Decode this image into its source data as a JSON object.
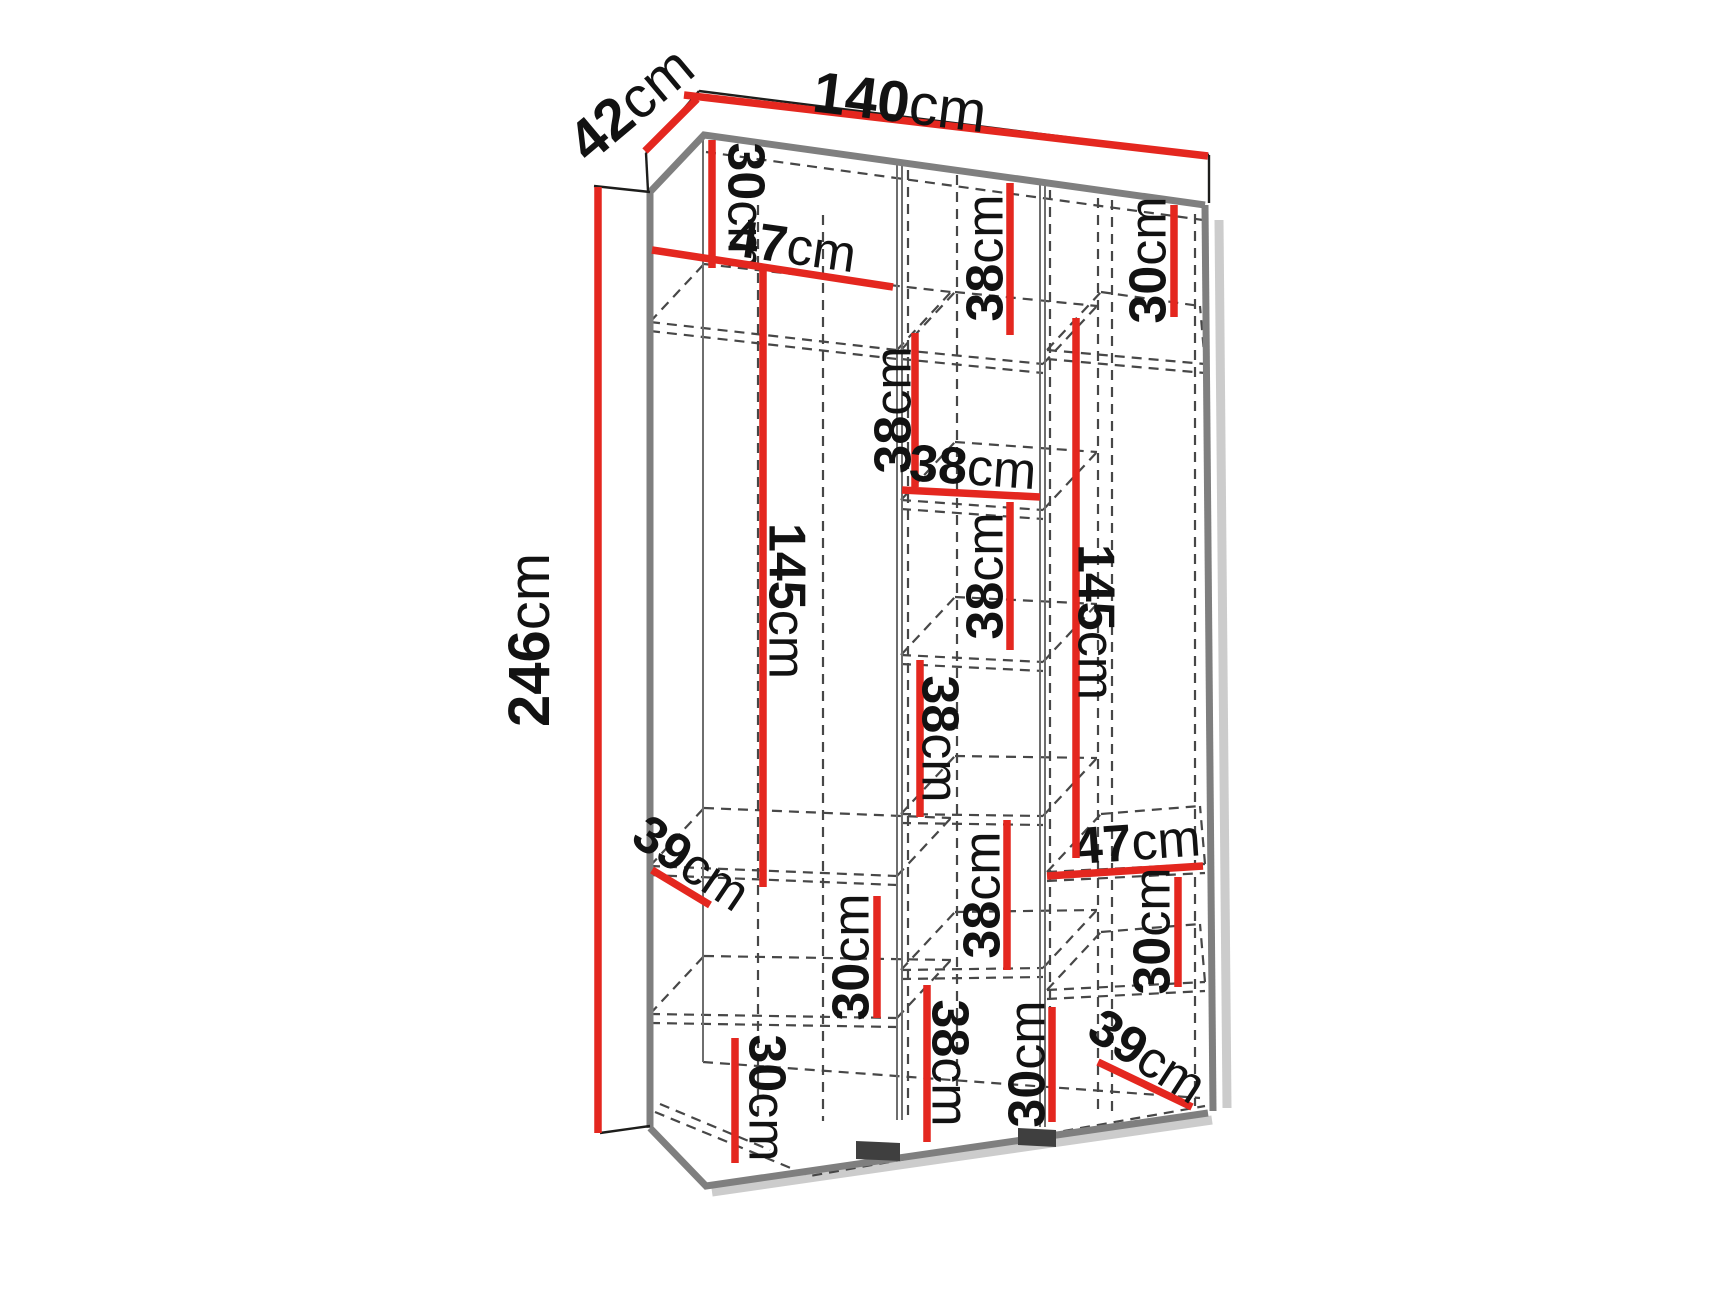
{
  "units": "cm",
  "colors": {
    "dimension_red": "#e4271f",
    "outline_black": "#1d1d1b",
    "panel_gray": "#7f7f7f",
    "partition_gray": "#6e6e6e",
    "dash_gray": "#474747",
    "feet_dark": "#3f3f3f",
    "shadow_gray": "#cccccc",
    "text_black": "#121212"
  },
  "overall_dimensions": {
    "width": {
      "value": "140",
      "unit": "cm"
    },
    "depth": {
      "value": "42",
      "unit": "cm"
    },
    "height": {
      "value": "246",
      "unit": "cm"
    }
  },
  "annotations": [
    {
      "id": "depth-42cm",
      "value": "42",
      "unit": "cm",
      "label": [
        630,
        103,
        -40,
        58
      ],
      "line": [
        645,
        151,
        697,
        99
      ]
    },
    {
      "id": "width-140cm",
      "value": "140",
      "unit": "cm",
      "label": [
        900,
        101,
        7,
        58
      ],
      "line": [
        684,
        95,
        1208,
        156
      ]
    },
    {
      "id": "height-246cm",
      "value": "246",
      "unit": "cm",
      "label": [
        528,
        640,
        -90,
        58
      ],
      "line": [
        598,
        187,
        598,
        1133
      ]
    },
    {
      "id": "top-left-30cm",
      "value": "30",
      "unit": "cm",
      "label": [
        747,
        206,
        90,
        52
      ],
      "line": [
        712,
        140,
        712,
        268
      ]
    },
    {
      "id": "top-left-47cm",
      "value": "47",
      "unit": "cm",
      "label": [
        793,
        245,
        8,
        52
      ],
      "line": [
        652,
        250,
        893,
        287
      ]
    },
    {
      "id": "top-mid-38cm",
      "value": "38",
      "unit": "cm",
      "label": [
        984,
        258,
        -90,
        52
      ],
      "line": [
        1010,
        183,
        1010,
        335
      ]
    },
    {
      "id": "top-right-30cm",
      "value": "30",
      "unit": "cm",
      "label": [
        1147,
        260,
        -90,
        52
      ],
      "line": [
        1174,
        205,
        1174,
        317
      ]
    },
    {
      "id": "mid-38cm-a",
      "value": "38",
      "unit": "cm",
      "label": [
        892,
        410,
        -90,
        52
      ],
      "line": [
        915,
        333,
        915,
        487
      ]
    },
    {
      "id": "mid-width-38cm",
      "value": "38",
      "unit": "cm",
      "label": [
        973,
        466,
        4,
        52
      ],
      "line": [
        902,
        490,
        1040,
        497
      ]
    },
    {
      "id": "mid-38cm-b",
      "value": "38",
      "unit": "cm",
      "label": [
        984,
        576,
        -90,
        52
      ],
      "line": [
        1010,
        502,
        1010,
        650
      ]
    },
    {
      "id": "mid-38cm-c",
      "value": "38",
      "unit": "cm",
      "label": [
        941,
        739,
        90,
        52
      ],
      "line": [
        920,
        660,
        920,
        817
      ]
    },
    {
      "id": "mid-38cm-d",
      "value": "38",
      "unit": "cm",
      "label": [
        981,
        895,
        -90,
        52
      ],
      "line": [
        1007,
        820,
        1007,
        970
      ]
    },
    {
      "id": "right-47cm",
      "value": "47",
      "unit": "cm",
      "label": [
        1137,
        841,
        -4,
        52
      ],
      "line": [
        1047,
        876,
        1203,
        866
      ]
    },
    {
      "id": "right-30cm",
      "value": "30",
      "unit": "cm",
      "label": [
        1151,
        931,
        -90,
        52
      ],
      "line": [
        1178,
        877,
        1178,
        987
      ]
    },
    {
      "id": "left-depth-39cm",
      "value": "39",
      "unit": "cm",
      "label": [
        692,
        862,
        34,
        52
      ],
      "line": [
        652,
        870,
        710,
        905
      ]
    },
    {
      "id": "left-30cm",
      "value": "30",
      "unit": "cm",
      "label": [
        850,
        957,
        -90,
        52
      ],
      "line": [
        877,
        896,
        877,
        1018
      ]
    },
    {
      "id": "bottom-left-30cm",
      "value": "30",
      "unit": "cm",
      "label": [
        768,
        1098,
        90,
        52
      ],
      "line": [
        735,
        1038,
        735,
        1163
      ]
    },
    {
      "id": "bottom-mid-38cm",
      "value": "38",
      "unit": "cm",
      "label": [
        951,
        1063,
        90,
        52
      ],
      "line": [
        927,
        985,
        927,
        1142
      ]
    },
    {
      "id": "bottom-mid-30cm",
      "value": "30",
      "unit": "cm",
      "label": [
        1026,
        1064,
        -90,
        52
      ],
      "line": [
        1052,
        1007,
        1052,
        1122
      ]
    },
    {
      "id": "right-depth-39cm",
      "value": "39",
      "unit": "cm",
      "label": [
        1148,
        1055,
        33,
        52
      ],
      "line": [
        1098,
        1062,
        1192,
        1107
      ]
    },
    {
      "id": "left-145cm",
      "value": "145",
      "unit": "cm",
      "label": [
        788,
        601,
        90,
        52
      ],
      "line": [
        763,
        264,
        763,
        887
      ]
    },
    {
      "id": "right-145cm",
      "value": "145",
      "unit": "cm",
      "label": [
        1097,
        622,
        90,
        52
      ],
      "line": [
        1076,
        318,
        1076,
        858
      ]
    }
  ],
  "structure": {
    "depth_vector": [
      54,
      -58
    ],
    "clip_max_x": 1200,
    "shelf_thickness": 9,
    "solid_black": [
      [
        699,
        91,
        1209,
        155
      ],
      [
        1209,
        155,
        1209,
        203
      ],
      [
        699,
        91,
        646,
        153
      ],
      [
        646,
        153,
        648,
        191
      ],
      [
        594,
        186,
        650,
        192
      ],
      [
        598,
        190,
        598,
        1133
      ],
      [
        600,
        1133,
        650,
        1126
      ]
    ],
    "thick_gray_paths": [
      [
        [
          650,
          192
        ],
        [
          704,
          135
        ],
        [
          1205,
          205
        ]
      ],
      [
        [
          650,
          192
        ],
        [
          650,
          1128
        ]
      ],
      [
        [
          1205,
          205
        ],
        [
          1213,
          1111
        ]
      ],
      [
        [
          650,
          1128
        ],
        [
          706,
          1186
        ],
        [
          1208,
          1113
        ]
      ]
    ],
    "thin_gray": [
      [
        703,
        140,
        703,
        1062
      ],
      [
        897,
        163,
        897,
        1120
      ],
      [
        902,
        164,
        902,
        1120
      ],
      [
        1040,
        181,
        1040,
        1127
      ],
      [
        1045,
        182,
        1045,
        1127
      ]
    ],
    "dashed": [
      [
        758,
        205,
        758,
        1122
      ],
      [
        823,
        215,
        823,
        1121
      ],
      [
        908,
        170,
        908,
        1119
      ],
      [
        957,
        175,
        957,
        1117
      ],
      [
        1050,
        190,
        1050,
        1114
      ],
      [
        1098,
        198,
        1098,
        1112
      ],
      [
        1112,
        200,
        1112,
        1112
      ],
      [
        1195,
        214,
        1195,
        1106
      ],
      [
        706,
        152,
        1203,
        220
      ],
      [
        703,
        1062,
        1200,
        1098
      ]
    ],
    "dashed_paths": [
      [
        [
          655,
          1112
        ],
        [
          810,
          1176
        ],
        [
          1205,
          1106
        ]
      ],
      [
        [
          660,
          1104
        ],
        [
          770,
          1150
        ]
      ]
    ],
    "shelves": [
      [
        650,
        322,
        897,
        350
      ],
      [
        650,
        866,
        897,
        876
      ],
      [
        650,
        1014,
        897,
        1018
      ],
      [
        901,
        350,
        1043,
        364
      ],
      [
        901,
        500,
        1043,
        510
      ],
      [
        901,
        655,
        1043,
        662
      ],
      [
        901,
        814,
        1043,
        816
      ],
      [
        901,
        970,
        1043,
        968
      ],
      [
        1047,
        350,
        1205,
        364
      ],
      [
        1047,
        872,
        1205,
        864
      ],
      [
        1047,
        990,
        1205,
        982
      ]
    ],
    "feet": [
      [
        [
          856,
          1141
        ],
        [
          900,
          1143
        ],
        [
          900,
          1161
        ],
        [
          856,
          1159
        ]
      ],
      [
        [
          1018,
          1128
        ],
        [
          1056,
          1130
        ],
        [
          1056,
          1147
        ],
        [
          1018,
          1145
        ]
      ]
    ],
    "shadows": [
      [
        1219,
        220,
        1227,
        1108
      ],
      [
        712,
        1192,
        1212,
        1120
      ]
    ]
  }
}
